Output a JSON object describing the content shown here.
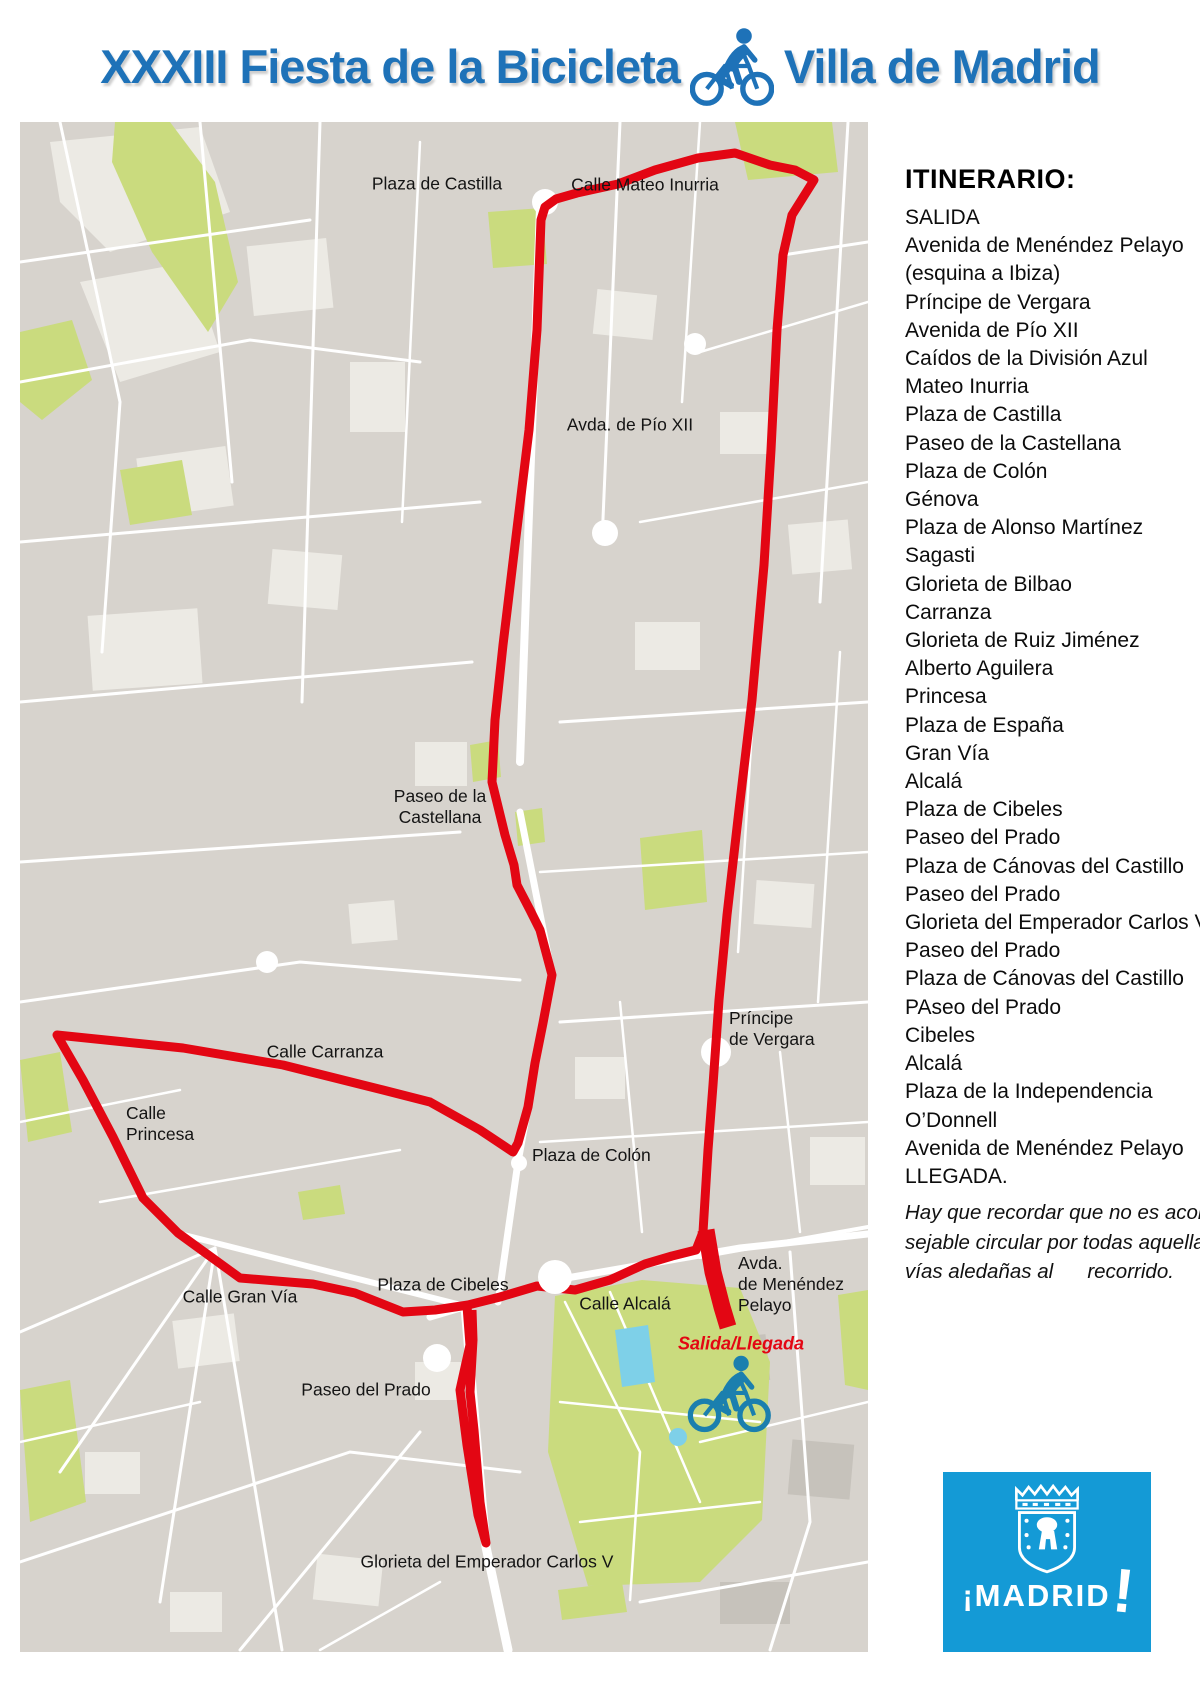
{
  "title": {
    "left": "XXXIII Fiesta de la Bicicleta",
    "right": "Villa de Madrid"
  },
  "itinerary": {
    "heading": "ITINERARIO:",
    "items": [
      "SALIDA",
      "Avenida de Menéndez Pelayo",
      "(esquina a Ibiza)",
      "Príncipe de Vergara",
      "Avenida de Pío XII",
      "Caídos de la División Azul",
      "Mateo Inurria",
      "Plaza de Castilla",
      "Paseo de la Castellana",
      "Plaza de Colón",
      "Génova",
      "Plaza de Alonso Martínez",
      "Sagasti",
      "Glorieta de Bilbao",
      "Carranza",
      "Glorieta de Ruiz Jiménez",
      "Alberto Aguilera",
      "Princesa",
      "Plaza de España",
      "Gran Vía",
      "Alcalá",
      "Plaza de Cibeles",
      "Paseo del Prado",
      "Plaza de Cánovas del Castillo",
      "Paseo del Prado",
      "Glorieta del Emperador Carlos V",
      "Paseo del Prado",
      "Plaza de Cánovas del Castillo",
      "PAseo del Prado",
      "Cibeles",
      "Alcalá",
      "Plaza de la Independencia",
      " O’Donnell",
      "Avenida de Menéndez Pelayo",
      "LLEGADA."
    ],
    "note_lines": [
      "Hay que recordar que no es acon-",
      "sejable circular por todas aquellas",
      "vías aledañas al      recorrido."
    ]
  },
  "map": {
    "labels": [
      {
        "id": "plaza-de-castilla",
        "text": "Plaza de Castilla",
        "x": 437,
        "y": 184,
        "align": "center"
      },
      {
        "id": "calle-mateo-inurria",
        "text": "Calle Mateo Inurria",
        "x": 645,
        "y": 185,
        "align": "center"
      },
      {
        "id": "avda-de-pio-xii",
        "text": "Avda. de Pío XII",
        "x": 630,
        "y": 425,
        "align": "center"
      },
      {
        "id": "paseo-de-la-castellana",
        "text": "Paseo de la\nCastellana",
        "x": 440,
        "y": 807,
        "align": "center"
      },
      {
        "id": "principe-de-vergara",
        "text": "Príncipe\nde Vergara",
        "x": 729,
        "y": 1008,
        "align": "left"
      },
      {
        "id": "calle-carranza",
        "text": "Calle Carranza",
        "x": 325,
        "y": 1052,
        "align": "center"
      },
      {
        "id": "calle-princesa",
        "text": "Calle\nPrincesa",
        "x": 126,
        "y": 1103,
        "align": "left"
      },
      {
        "id": "plaza-de-colon",
        "text": "Plaza de Colón",
        "x": 532,
        "y": 1145,
        "align": "left"
      },
      {
        "id": "calle-gran-via",
        "text": "Calle Gran Vía",
        "x": 240,
        "y": 1297,
        "align": "center"
      },
      {
        "id": "plaza-de-cibeles",
        "text": "Plaza de Cibeles",
        "x": 443,
        "y": 1285,
        "align": "center"
      },
      {
        "id": "calle-alcala",
        "text": "Calle Alcalá",
        "x": 625,
        "y": 1304,
        "align": "center"
      },
      {
        "id": "avda-menendez-pelayo",
        "text": "Avda.\nde Menéndez\nPelayo",
        "x": 738,
        "y": 1253,
        "align": "left"
      },
      {
        "id": "salida-llegada",
        "text": "Salida/Llegada",
        "x": 741,
        "y": 1344,
        "align": "center",
        "style": "red"
      },
      {
        "id": "paseo-del-prado",
        "text": "Paseo del Prado",
        "x": 366,
        "y": 1390,
        "align": "center"
      },
      {
        "id": "glorieta-emperador-carlos-v",
        "text": "Glorieta del Emperador Carlos V",
        "x": 487,
        "y": 1562,
        "align": "center"
      }
    ]
  },
  "logo": {
    "open_excl": "¡",
    "word": "MADRID",
    "close_excl": "!"
  },
  "colors": {
    "title_blue": "#1e72b8",
    "route_red": "#e30613",
    "logo_blue": "#149ad6",
    "map_background": "#d7d3cd",
    "park_green": "#cadb7e",
    "pond_blue": "#7ed0e8"
  }
}
